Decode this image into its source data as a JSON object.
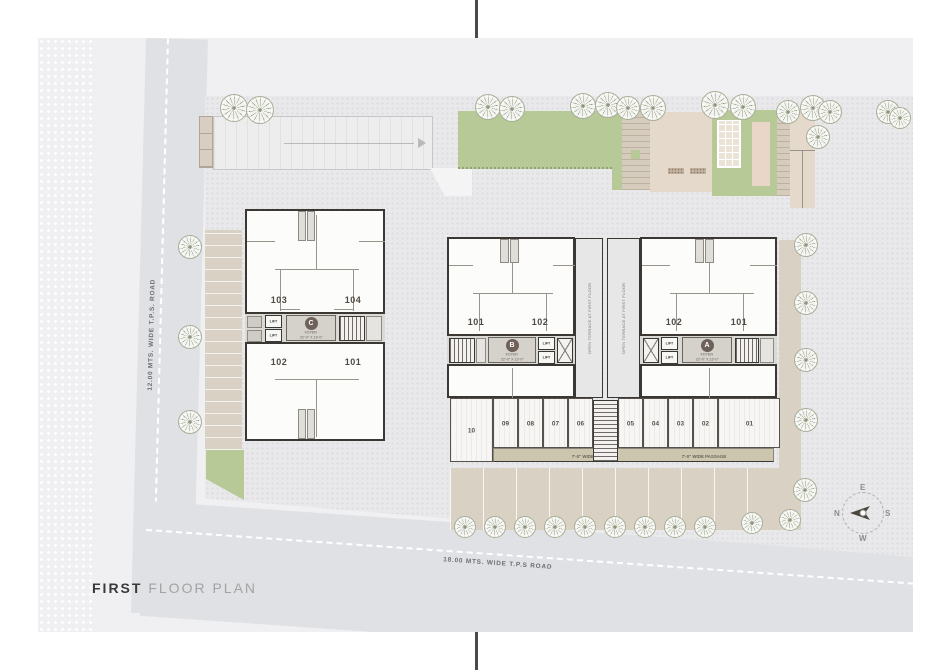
{
  "title": {
    "bold": "FIRST",
    "rest": " FLOOR PLAN"
  },
  "roads": {
    "left": "12.00 MTS. WIDE T.P.S. ROAD",
    "bottom": "18.00 MTS. WIDE T.P.S ROAD"
  },
  "compass": {
    "n": "N",
    "e": "E",
    "s": "S",
    "w": "W"
  },
  "labels": {
    "lift": "LIFT",
    "foyer": "FOYER",
    "foyer_dim": "22'-0\" X 13'-0\"",
    "terrace": "OPEN TERRACE AT FIRST FLOOR",
    "passage": "7'-0\" WIDE PASSAGE"
  },
  "towers": {
    "c": {
      "badge": "C",
      "units": [
        "103",
        "104",
        "102",
        "101"
      ]
    },
    "b": {
      "badge": "B",
      "units": [
        "101",
        "102"
      ]
    },
    "a": {
      "badge": "A",
      "units": [
        "102",
        "101"
      ]
    }
  },
  "shops": [
    "10",
    "09",
    "08",
    "07",
    "06",
    "05",
    "04",
    "03",
    "02",
    "01"
  ],
  "colors": {
    "sheet": "#f0f0f2",
    "plot": "#e9e9eb",
    "road": "#e0e1e4",
    "wall": "#3b3833",
    "badge": "#6e6159",
    "green": "#b7c996",
    "tan": "#d9d2c4",
    "passage_tan": "#cbc6ad",
    "tree": "#8f967e"
  }
}
